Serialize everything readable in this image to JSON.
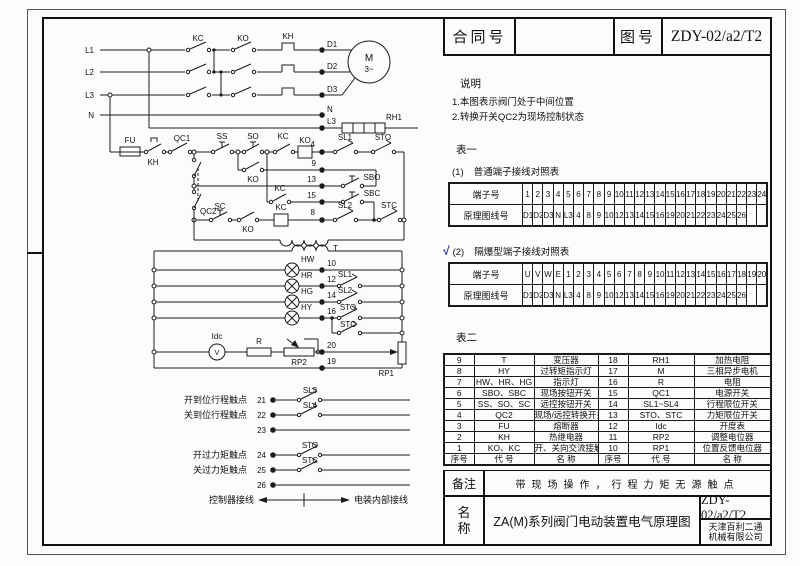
{
  "title_block": {
    "contract_label": "合同号",
    "contract_value": "",
    "drawing_label": "图号",
    "drawing_no": "ZDY-02/a2/T2"
  },
  "notes": {
    "heading": "说明",
    "items": [
      "1.本图表示阀门处于中间位置",
      "2.转换开关QC2为现场控制状态"
    ]
  },
  "table1": {
    "heading": "表一",
    "terminal_label": "端子号",
    "wire_label": "原理图线号",
    "sections": [
      {
        "check": "",
        "num": "(1)",
        "title": "普通端子接线对照表",
        "terminals": [
          "1",
          "2",
          "3",
          "4",
          "5",
          "6",
          "7",
          "8",
          "9",
          "10",
          "11",
          "12",
          "13",
          "14",
          "15",
          "16",
          "17",
          "18",
          "19",
          "20",
          "21",
          "22",
          "23",
          "24"
        ],
        "wires": [
          "D1",
          "D2",
          "D3",
          "N",
          "L3",
          "4",
          "8",
          "9",
          "10",
          "12",
          "13",
          "14",
          "15",
          "16",
          "19",
          "20",
          "21",
          "22",
          "23",
          "24",
          "25",
          "26",
          "",
          ""
        ]
      },
      {
        "check": "√",
        "num": "(2)",
        "title": "隔爆型端子接线对照表",
        "terminals": [
          "U",
          "V",
          "W",
          "E",
          "1",
          "2",
          "3",
          "4",
          "5",
          "6",
          "7",
          "8",
          "9",
          "10",
          "11",
          "12",
          "13",
          "14",
          "15",
          "16",
          "17",
          "18",
          "19",
          "20"
        ],
        "wires": [
          "D1",
          "D2",
          "D3",
          "N",
          "L3",
          "4",
          "8",
          "9",
          "10",
          "12",
          "13",
          "14",
          "15",
          "16",
          "19",
          "20",
          "21",
          "22",
          "23",
          "24",
          "25",
          "26",
          "",
          ""
        ]
      }
    ]
  },
  "table2": {
    "heading": "表二",
    "rows": [
      [
        "9",
        "T",
        "变压器",
        "18",
        "RH1",
        "加热电阻"
      ],
      [
        "8",
        "HY",
        "过转矩指示灯",
        "17",
        "M",
        "三相异步电机"
      ],
      [
        "7",
        "HW、HR、HG",
        "指示灯",
        "16",
        "R",
        "电阻"
      ],
      [
        "6",
        "SBO、SBC",
        "现场按钮开关",
        "15",
        "QC1",
        "电源开关"
      ],
      [
        "5",
        "SS、SO、SC",
        "远控按钮开关",
        "14",
        "SL1~SL4",
        "行程限位开关"
      ],
      [
        "4",
        "QC2",
        "现场/远控转换开关",
        "13",
        "STO、STC",
        "力矩限位开关"
      ],
      [
        "3",
        "FU",
        "熔断器",
        "12",
        "Idc",
        "开度表"
      ],
      [
        "2",
        "KH",
        "热继电器",
        "11",
        "RP2",
        "调整电位器"
      ],
      [
        "1",
        "KO、KC",
        "开、关向交流接触器",
        "10",
        "RP1",
        "位置反馈电位器"
      ]
    ],
    "footer": [
      "序号",
      "代 号",
      "名 称",
      "序号",
      "代 号",
      "名 称"
    ]
  },
  "remarks": {
    "label": "备注",
    "value": "带现场操作，行程力矩无源触点"
  },
  "name_block": {
    "label": "名称",
    "title": "ZA(M)系列阀门电动装置电气原理图",
    "drawing_no": "ZDY-02/a2/T2",
    "company": [
      "天津百利二通",
      "机械有限公司"
    ]
  },
  "colors": {
    "line": "#1b1b1b",
    "check": "#2b3a9a"
  },
  "schematic": {
    "texts": [
      {
        "x": 52,
        "y": 43,
        "t": "L1",
        "a": "e"
      },
      {
        "x": 52,
        "y": 65,
        "t": "L2",
        "a": "e"
      },
      {
        "x": 52,
        "y": 88,
        "t": "L3",
        "a": "e"
      },
      {
        "x": 52,
        "y": 108,
        "t": "N",
        "a": "e"
      },
      {
        "x": 156,
        "y": 31,
        "t": "KC"
      },
      {
        "x": 201,
        "y": 31,
        "t": "KO"
      },
      {
        "x": 246,
        "y": 29,
        "t": "KH"
      },
      {
        "x": 285,
        "y": 37,
        "t": "D1",
        "a": "s"
      },
      {
        "x": 285,
        "y": 59,
        "t": "D2",
        "a": "s"
      },
      {
        "x": 285,
        "y": 82,
        "t": "D3",
        "a": "s"
      },
      {
        "x": 285,
        "y": 102,
        "t": "N",
        "a": "s"
      },
      {
        "x": 327,
        "y": 51,
        "t": "M",
        "s": 10
      },
      {
        "x": 327,
        "y": 62,
        "t": "3~"
      },
      {
        "x": 285,
        "y": 114,
        "t": "L3",
        "a": "s"
      },
      {
        "x": 352,
        "y": 110,
        "t": "RH1"
      },
      {
        "x": 88,
        "y": 133,
        "t": "FU"
      },
      {
        "x": 111,
        "y": 155,
        "t": "KH"
      },
      {
        "x": 140,
        "y": 131,
        "t": "QC1"
      },
      {
        "x": 180,
        "y": 129,
        "t": "SS"
      },
      {
        "x": 211,
        "y": 129,
        "t": "SO"
      },
      {
        "x": 241,
        "y": 129,
        "t": "KC"
      },
      {
        "x": 263,
        "y": 133,
        "t": "KO"
      },
      {
        "x": 273,
        "y": 137,
        "t": "4",
        "a": "e"
      },
      {
        "x": 303,
        "y": 130,
        "t": "SL1"
      },
      {
        "x": 341,
        "y": 130,
        "t": "STO"
      },
      {
        "x": 211,
        "y": 172,
        "t": "KO"
      },
      {
        "x": 274,
        "y": 156,
        "t": "9",
        "a": "e"
      },
      {
        "x": 274,
        "y": 172,
        "t": "13",
        "a": "e"
      },
      {
        "x": 330,
        "y": 170,
        "t": "SBO"
      },
      {
        "x": 238,
        "y": 181,
        "t": "KC"
      },
      {
        "x": 274,
        "y": 188,
        "t": "15",
        "a": "e"
      },
      {
        "x": 330,
        "y": 186,
        "t": "SBC"
      },
      {
        "x": 178,
        "y": 199,
        "t": "SC"
      },
      {
        "x": 206,
        "y": 222,
        "t": "KO"
      },
      {
        "x": 239,
        "y": 200,
        "t": "KC"
      },
      {
        "x": 273,
        "y": 205,
        "t": "8",
        "a": "e"
      },
      {
        "x": 303,
        "y": 198,
        "t": "SL2"
      },
      {
        "x": 347,
        "y": 198,
        "t": "STC"
      },
      {
        "x": 158,
        "y": 204,
        "t": "QC2",
        "a": "s"
      },
      {
        "x": 291,
        "y": 241,
        "t": "T",
        "a": "s"
      },
      {
        "x": 259,
        "y": 252,
        "t": "HW",
        "a": "s"
      },
      {
        "x": 285,
        "y": 256,
        "t": "10",
        "a": "s"
      },
      {
        "x": 259,
        "y": 268,
        "t": "HR",
        "a": "s"
      },
      {
        "x": 285,
        "y": 272,
        "t": "12",
        "a": "s"
      },
      {
        "x": 303,
        "y": 267,
        "t": "SL1"
      },
      {
        "x": 259,
        "y": 284,
        "t": "HG",
        "a": "s"
      },
      {
        "x": 285,
        "y": 288,
        "t": "14",
        "a": "s"
      },
      {
        "x": 303,
        "y": 283,
        "t": "SL2"
      },
      {
        "x": 259,
        "y": 300,
        "t": "HY",
        "a": "s"
      },
      {
        "x": 285,
        "y": 304,
        "t": "16",
        "a": "s"
      },
      {
        "x": 306,
        "y": 300,
        "t": "STO"
      },
      {
        "x": 306,
        "y": 317,
        "t": "STC"
      },
      {
        "x": 175,
        "y": 329,
        "t": "Idc"
      },
      {
        "x": 175,
        "y": 345,
        "t": "V",
        "s": 7
      },
      {
        "x": 217,
        "y": 334,
        "t": "R"
      },
      {
        "x": 257,
        "y": 355,
        "t": "RP2"
      },
      {
        "x": 285,
        "y": 338,
        "t": "20",
        "a": "s"
      },
      {
        "x": 352,
        "y": 366,
        "t": "RP1",
        "a": "e"
      },
      {
        "x": 285,
        "y": 354,
        "t": "19",
        "a": "s"
      },
      {
        "x": 205,
        "y": 393,
        "t": "开到位行程触点",
        "a": "e",
        "s": 9
      },
      {
        "x": 224,
        "y": 393,
        "t": "21",
        "a": "e"
      },
      {
        "x": 268,
        "y": 383,
        "t": "SL3"
      },
      {
        "x": 205,
        "y": 408,
        "t": "关到位行程触点",
        "a": "e",
        "s": 9
      },
      {
        "x": 224,
        "y": 408,
        "t": "22",
        "a": "e"
      },
      {
        "x": 268,
        "y": 398,
        "t": "SL4"
      },
      {
        "x": 224,
        "y": 423,
        "t": "23",
        "a": "e"
      },
      {
        "x": 205,
        "y": 448,
        "t": "开过力矩触点",
        "a": "e",
        "s": 9
      },
      {
        "x": 224,
        "y": 448,
        "t": "24",
        "a": "e"
      },
      {
        "x": 268,
        "y": 438,
        "t": "STO"
      },
      {
        "x": 205,
        "y": 463,
        "t": "关过力矩触点",
        "a": "e",
        "s": 9
      },
      {
        "x": 224,
        "y": 463,
        "t": "25",
        "a": "e"
      },
      {
        "x": 268,
        "y": 453,
        "t": "STC"
      },
      {
        "x": 224,
        "y": 478,
        "t": "26",
        "a": "e"
      },
      {
        "x": 212,
        "y": 493,
        "t": "控制器接线",
        "a": "e",
        "s": 9
      },
      {
        "x": 312,
        "y": 493,
        "t": "电装内部接线",
        "a": "s",
        "s": 9
      }
    ]
  }
}
